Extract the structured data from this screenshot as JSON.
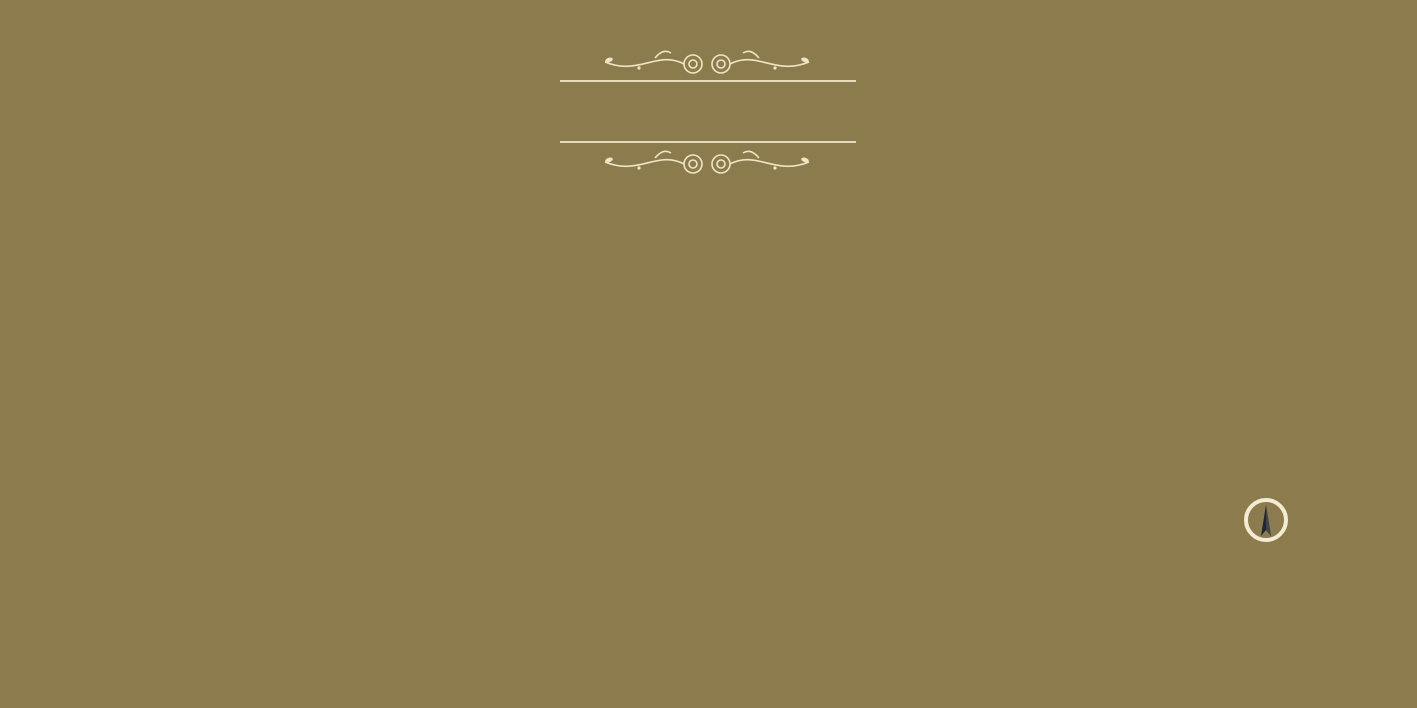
{
  "header": {
    "title": "ALPHA",
    "subtitle": "A new home for you"
  },
  "watermark": {
    "line1": "square",
    "line2": "yards"
  },
  "compass": {
    "label": "N"
  },
  "footer": {
    "tagline": "Thoughtfully well planned and Vasthu Compliant Apartments to bring peace and prosperity in your life."
  },
  "colors": {
    "background": "#8c7b4d",
    "wall": "#241c12",
    "floor": "#efe2c4",
    "window_blue": "#3fb3da",
    "tile": "#f7f4ec",
    "counter_teal": "#1b4047",
    "title_cream": "#f5edd3"
  },
  "plan": {
    "bases": [
      [
        96,
        296,
        196,
        250
      ],
      [
        56,
        296,
        62,
        122
      ],
      [
        284,
        344,
        94,
        222
      ],
      [
        378,
        284,
        142,
        270
      ],
      [
        492,
        270,
        176,
        298
      ],
      [
        656,
        238,
        296,
        320
      ],
      [
        940,
        246,
        112,
        334
      ],
      [
        1052,
        238,
        150,
        282
      ],
      [
        1196,
        238,
        178,
        208
      ]
    ],
    "rooms": [
      {
        "t": "toilet",
        "l": "Toilet",
        "d": "4'6\"X6'6\"",
        "x": 58,
        "y": 296,
        "w": 58,
        "h": 62
      },
      {
        "t": "toilet",
        "l": "Toilet",
        "d": "7'X4'",
        "x": 56,
        "y": 360,
        "w": 54,
        "h": 54
      },
      {
        "t": "bedroom",
        "l": "Bedroom",
        "d": "12'9\"X11'",
        "x": 96,
        "y": 308,
        "w": 120,
        "h": 80,
        "f": "h"
      },
      {
        "t": "pass",
        "l": "Pass.",
        "d": "3'X5'5\"",
        "x": 170,
        "y": 388,
        "w": 46,
        "h": 26
      },
      {
        "t": "bedroom",
        "l": "Bedroom",
        "d": "12'7\"X9'8\"",
        "x": 96,
        "y": 416,
        "w": 74,
        "h": 50
      },
      {
        "t": "pass",
        "l": "Pass.",
        "d": "3'X4'7\"",
        "x": 170,
        "y": 432,
        "w": 46,
        "h": 24
      },
      {
        "t": "bedroom",
        "l": "Bedroom",
        "d": "11'X9'8\"",
        "x": 108,
        "y": 466,
        "w": 108,
        "h": 76,
        "f": "v"
      },
      {
        "t": "living",
        "l": "Living",
        "d": "11'X21'",
        "x": 216,
        "y": 306,
        "w": 76,
        "h": 164
      },
      {
        "t": "kitchen",
        "l": "KITCHEN",
        "d": "11' X 8'",
        "x": 216,
        "y": 470,
        "w": 76,
        "h": 76,
        "cs": "right"
      },
      {
        "t": "toilet",
        "l": "Toilet",
        "d": "7'X4'",
        "x": 114,
        "y": 534,
        "w": 84,
        "h": 38
      },
      {
        "t": "lift",
        "l": "Lift",
        "x": 288,
        "y": 346,
        "w": 42,
        "h": 50
      },
      {
        "t": "lift",
        "l": "Lift",
        "x": 334,
        "y": 346,
        "w": 42,
        "h": 50
      },
      {
        "t": "lobby",
        "l": "Lobby",
        "d": "12'4\"X7'6\"",
        "x": 286,
        "y": 398,
        "w": 92,
        "h": 62
      },
      {
        "t": "stair",
        "a": "DN",
        "b": "UP",
        "x": 286,
        "y": 462,
        "w": 92,
        "h": 100
      },
      {
        "t": "living",
        "l": "Living",
        "d": "10'X10'7\"",
        "x": 378,
        "y": 308,
        "w": 72,
        "h": 116
      },
      {
        "t": "kitchen",
        "l": "Kitchen",
        "d": "8'3\"X9'7\"",
        "x": 452,
        "y": 284,
        "w": 68,
        "h": 96,
        "cs": "right"
      },
      {
        "t": "dining",
        "l": "Dining",
        "d": "3'10\"X6'8\"",
        "x": 428,
        "y": 374,
        "w": 62,
        "h": 44
      },
      {
        "t": "dining",
        "l": "Dining",
        "d": "3'10\"X6'8\"",
        "x": 428,
        "y": 424,
        "w": 62,
        "h": 44
      },
      {
        "t": "living",
        "l": "Living",
        "d": "10'X17'2\"",
        "x": 378,
        "y": 428,
        "w": 72,
        "h": 118
      },
      {
        "t": "kitchen",
        "l": "Kitchen",
        "d": "8'3\"X10'",
        "x": 452,
        "y": 470,
        "w": 68,
        "h": 82,
        "cs": "right"
      },
      {
        "t": "bedroom",
        "l": "Bedroom",
        "d": "9'6\"X11'9\"",
        "x": 514,
        "y": 270,
        "w": 78,
        "h": 86,
        "f": "h"
      },
      {
        "t": "bedroom",
        "l": "Bedroom",
        "d": "9'6\"X10'2\"",
        "x": 594,
        "y": 270,
        "w": 74,
        "h": 86,
        "f": "h"
      },
      {
        "t": "pass",
        "l": "Pass.",
        "d": "7'6\"X3'",
        "x": 494,
        "y": 358,
        "w": 56,
        "h": 20
      },
      {
        "t": "pass",
        "l": "Pass.",
        "d": "5'11\"X3'",
        "x": 552,
        "y": 358,
        "w": 86,
        "h": 20
      },
      {
        "t": "toilet",
        "l": "Toilet",
        "d": "7'X4'1\"",
        "x": 494,
        "y": 380,
        "w": 60,
        "h": 36
      },
      {
        "t": "toilet",
        "l": "Toilet",
        "d": "7'X4'1\"",
        "x": 608,
        "y": 380,
        "w": 60,
        "h": 36
      },
      {
        "t": "shaft",
        "x": 556,
        "y": 380,
        "w": 50,
        "h": 76
      },
      {
        "t": "toilet",
        "l": "Toilet",
        "d": "7'X4'1\"",
        "x": 494,
        "y": 420,
        "w": 60,
        "h": 36
      },
      {
        "t": "toilet",
        "l": "Toilet",
        "d": "7'X4'1\"",
        "x": 608,
        "y": 420,
        "w": 60,
        "h": 36
      },
      {
        "t": "pass",
        "l": "Pass.",
        "d": "7'6\"X3'",
        "x": 494,
        "y": 458,
        "w": 56,
        "h": 20
      },
      {
        "t": "pass",
        "l": "Pass.",
        "d": "5'11\"X3'",
        "x": 552,
        "y": 458,
        "w": 86,
        "h": 20
      },
      {
        "t": "bedroom",
        "l": "Bedroom",
        "d": "9'6\"X11'1\"",
        "x": 514,
        "y": 480,
        "w": 78,
        "h": 86,
        "f": "v"
      },
      {
        "t": "bedroom",
        "l": "Bedroom",
        "d": "9'6\"X14'7\"",
        "x": 594,
        "y": 480,
        "w": 74,
        "h": 86,
        "f": "v"
      },
      {
        "t": "bedroom",
        "l": "Bedroom",
        "d": "9'6\"X10'7\"",
        "x": 660,
        "y": 238,
        "w": 84,
        "h": 112,
        "f": "v"
      },
      {
        "t": "bedroom",
        "l": "Bedroom",
        "d": "9'6\"X12'1\"",
        "x": 746,
        "y": 238,
        "w": 84,
        "h": 92,
        "f": "h"
      },
      {
        "t": "kitchen",
        "l": "Kitchen",
        "d": "7'6\"X12'1\"",
        "x": 810,
        "y": 238,
        "w": 58,
        "h": 128,
        "cs": "right"
      },
      {
        "t": "living",
        "l": "Living",
        "d": "10' X 20'1\"",
        "x": 870,
        "y": 238,
        "w": 80,
        "h": 172
      },
      {
        "t": "pass",
        "l": "Pass.",
        "d": "7'X3'",
        "x": 726,
        "y": 332,
        "w": 56,
        "h": 18
      },
      {
        "t": "pass",
        "l": "Pass.",
        "d": "8'5\"X3'",
        "x": 786,
        "y": 332,
        "w": 68,
        "h": 18
      },
      {
        "t": "toilet",
        "l": "Toilet",
        "d": "7'X4'1\"",
        "x": 658,
        "y": 352,
        "w": 58,
        "h": 36
      },
      {
        "t": "toilet",
        "l": "Toilet",
        "d": "7'X4'1\"",
        "x": 658,
        "y": 392,
        "w": 58,
        "h": 36
      },
      {
        "t": "shaft",
        "x": 718,
        "y": 352,
        "w": 78,
        "h": 76
      },
      {
        "t": "toilet",
        "l": "Toilet",
        "d": "7'X4'1\"",
        "x": 798,
        "y": 352,
        "w": 58,
        "h": 36
      },
      {
        "t": "toilet",
        "l": "Toilet",
        "d": "7'X4'1\"",
        "x": 798,
        "y": 392,
        "w": 58,
        "h": 36
      },
      {
        "t": "dining",
        "l": "Dining",
        "d": "3'5\"X7'6\"",
        "x": 842,
        "y": 348,
        "w": 60,
        "h": 40
      },
      {
        "t": "dining",
        "l": "Dining",
        "d": "3'5\"X7'6\"",
        "x": 842,
        "y": 392,
        "w": 60,
        "h": 40
      },
      {
        "t": "pass",
        "l": "Pass.",
        "d": "7'X3'",
        "x": 726,
        "y": 430,
        "w": 56,
        "h": 18
      },
      {
        "t": "pass",
        "l": "Pass.",
        "d": "8'5\"X3'",
        "x": 786,
        "y": 430,
        "w": 68,
        "h": 18
      },
      {
        "t": "bedroom",
        "l": "Bedroom",
        "d": "9'6\"X15'7\"",
        "x": 660,
        "y": 452,
        "w": 84,
        "h": 104,
        "f": "v"
      },
      {
        "t": "bedroom",
        "l": "Bedroom",
        "d": "9'6\"X12'1\"",
        "x": 746,
        "y": 446,
        "w": 84,
        "h": 88,
        "f": "v"
      },
      {
        "t": "kitchen",
        "l": "Kitchen",
        "d": "7'9\"X12'1\"",
        "x": 808,
        "y": 446,
        "w": 60,
        "h": 88,
        "cs": "right"
      },
      {
        "t": "living",
        "l": "Living",
        "d": "10'X20'1\"",
        "x": 870,
        "y": 412,
        "w": 80,
        "h": 122
      },
      {
        "t": "stair",
        "a": "UP",
        "b": "DN",
        "x": 944,
        "y": 248,
        "w": 96,
        "h": 110
      },
      {
        "t": "lobby",
        "l": "Lobby",
        "d": "14'4\"X7'7\"",
        "x": 944,
        "y": 362,
        "w": 106,
        "h": 60
      },
      {
        "t": "lift",
        "l": "Lift",
        "x": 944,
        "y": 426,
        "w": 50,
        "h": 58
      },
      {
        "t": "lift",
        "l": "Lift",
        "x": 998,
        "y": 426,
        "w": 50,
        "h": 58
      },
      {
        "t": "toilet",
        "l": "Toilet",
        "d": "4'X7'1\"",
        "x": 938,
        "y": 488,
        "w": 46,
        "h": 62
      },
      {
        "t": "bedroom",
        "l": "M. Bedroom",
        "d": "9'5\"X13'9\"",
        "x": 986,
        "y": 476,
        "w": 100,
        "h": 100,
        "f": "v"
      },
      {
        "t": "living",
        "l": "Living",
        "d": "10'X20'",
        "x": 1056,
        "y": 240,
        "w": 72,
        "h": 152
      },
      {
        "t": "kitchen",
        "l": "Kitchen",
        "d": "8'X12'6\"",
        "x": 1130,
        "y": 240,
        "w": 58,
        "h": 122,
        "cs": "right"
      },
      {
        "t": "bedroom",
        "l": "Bedroom",
        "d": "9'6\"X12'6\"",
        "x": 1192,
        "y": 240,
        "w": 94,
        "h": 94,
        "f": "h"
      },
      {
        "t": "bedroom",
        "l": "Bedroom",
        "d": "10'X16'",
        "x": 1288,
        "y": 240,
        "w": 84,
        "h": 94,
        "f": "h"
      },
      {
        "t": "pass",
        "l": "Pass.",
        "d": "10'8\"X3'",
        "x": 1192,
        "y": 338,
        "w": 96,
        "h": 18
      },
      {
        "t": "dining",
        "l": "Dining",
        "d": "6'6\"X7'",
        "x": 1130,
        "y": 364,
        "w": 66,
        "h": 28
      },
      {
        "t": "toilet",
        "l": "Toilet",
        "d": "4'X7'",
        "x": 1146,
        "y": 388,
        "w": 50,
        "h": 40
      },
      {
        "t": "toilet",
        "l": "Toilet",
        "d": "4'X7'",
        "x": 1198,
        "y": 388,
        "w": 38,
        "h": 40
      },
      {
        "t": "bedroom",
        "l": "Bedroom",
        "d": "10'6\"X11'7\"",
        "x": 1238,
        "y": 356,
        "w": 78,
        "h": 88,
        "f": "v"
      },
      {
        "t": "toilet",
        "l": "Toilet",
        "d": "4'6\"X6'6\"",
        "x": 1318,
        "y": 374,
        "w": 40,
        "h": 70
      },
      {
        "t": "toilet",
        "l": "Toilet",
        "d": "4'X7'",
        "x": 1342,
        "y": 326,
        "w": 32,
        "h": 46
      },
      {
        "t": "living",
        "l": "Living",
        "d": "10'X21'",
        "x": 1056,
        "y": 396,
        "w": 72,
        "h": 124
      },
      {
        "t": "dining",
        "l": "Dining",
        "d": "4'X7'2\"",
        "x": 1126,
        "y": 394,
        "w": 58,
        "h": 38
      },
      {
        "t": "kitchen",
        "l": "Kitchen",
        "d": "8'X6'10\"",
        "x": 1126,
        "y": 436,
        "w": 70,
        "h": 68,
        "cs": "right"
      }
    ],
    "chajas": [
      {
        "x": 116,
        "y": 286,
        "w": 176,
        "h": 24,
        "band": "bottom",
        "labels": [
          "Chaja",
          "Chaja"
        ]
      },
      {
        "x": 70,
        "y": 414,
        "w": 26,
        "h": 82,
        "v": true,
        "band": "right",
        "labels": [
          "Chaja"
        ]
      },
      {
        "x": 204,
        "y": 546,
        "w": 88,
        "h": 24,
        "band": "top",
        "labels": [
          "Chaja"
        ]
      },
      {
        "x": 286,
        "y": 564,
        "w": 90,
        "h": 24,
        "band": "top",
        "labels": [
          "Chaja"
        ]
      },
      {
        "x": 362,
        "y": 284,
        "w": 104,
        "h": 22,
        "band": "bottom",
        "labels": [
          "Chaja"
        ]
      },
      {
        "x": 450,
        "y": 262,
        "w": 78,
        "h": 22,
        "band": "bottom",
        "labels": [
          "Chaja"
        ]
      },
      {
        "x": 366,
        "y": 548,
        "w": 102,
        "h": 24,
        "band": "top",
        "labels": [
          "Chaja"
        ]
      },
      {
        "x": 454,
        "y": 556,
        "w": 84,
        "h": 22,
        "band": "top",
        "labels": [
          "Chaja"
        ]
      },
      {
        "x": 496,
        "y": 250,
        "w": 172,
        "h": 22,
        "band": "bottom",
        "labels": [
          "Chaja",
          "Chaja"
        ]
      },
      {
        "x": 496,
        "y": 566,
        "w": 172,
        "h": 24,
        "band": "top",
        "labels": [
          "Chaja",
          "Chaja"
        ]
      },
      {
        "x": 660,
        "y": 216,
        "w": 292,
        "h": 22,
        "band": "bottom",
        "labels": [
          "Chaja",
          "Chaja",
          "Chaja",
          "Chaja"
        ]
      },
      {
        "x": 660,
        "y": 558,
        "w": 86,
        "h": 24,
        "band": "top",
        "labels": [
          "Chaja"
        ]
      },
      {
        "x": 746,
        "y": 536,
        "w": 204,
        "h": 24,
        "band": "top",
        "labels": [
          "Chaja",
          "Chaja"
        ]
      },
      {
        "x": 944,
        "y": 222,
        "w": 104,
        "h": 24,
        "band": "bottom",
        "labels": [
          "Chaja"
        ]
      },
      {
        "x": 1032,
        "y": 344,
        "w": 58,
        "h": 20,
        "band": "bottom",
        "labels": [
          "Chaja"
        ]
      },
      {
        "x": 982,
        "y": 578,
        "w": 106,
        "h": 22,
        "band": "top",
        "labels": [
          "Chaja"
        ]
      },
      {
        "x": 1052,
        "y": 216,
        "w": 320,
        "h": 22,
        "band": "bottom",
        "labels": [
          "Chaja",
          "Chaja",
          "Chaja",
          "Chaja"
        ]
      },
      {
        "x": 1238,
        "y": 446,
        "w": 96,
        "h": 22,
        "band": "top",
        "labels": [
          "Chaja"
        ]
      },
      {
        "x": 1122,
        "y": 506,
        "w": 100,
        "h": 22,
        "band": "top",
        "labels": [
          "Chaja"
        ]
      }
    ]
  }
}
